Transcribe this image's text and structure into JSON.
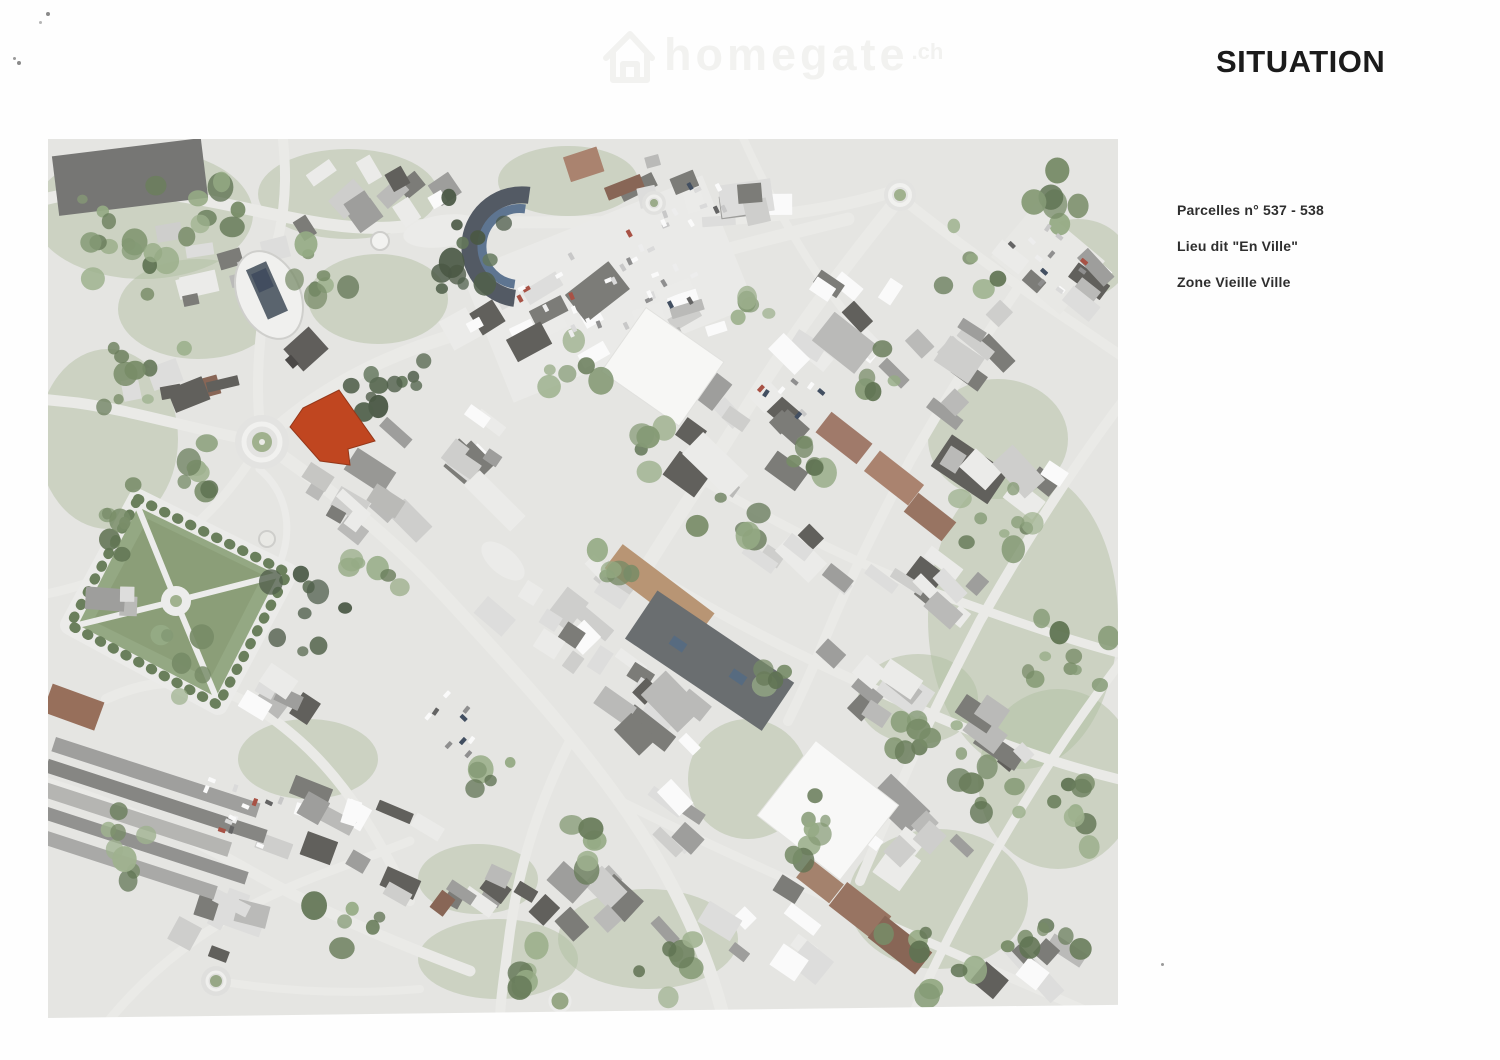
{
  "page": {
    "title": "SITUATION"
  },
  "watermark": {
    "brand": "homegate",
    "tld": ".ch"
  },
  "annotations": {
    "parcelles": "Parcelles n° 537 - 538",
    "lieu_dit": "Lieu dit \"En Ville\"",
    "zone": "Zone Vieille Ville"
  },
  "map": {
    "parcel_highlight_color": "#dc3e0c",
    "park_green": "#8ca673",
    "road_color": "#ededea"
  }
}
